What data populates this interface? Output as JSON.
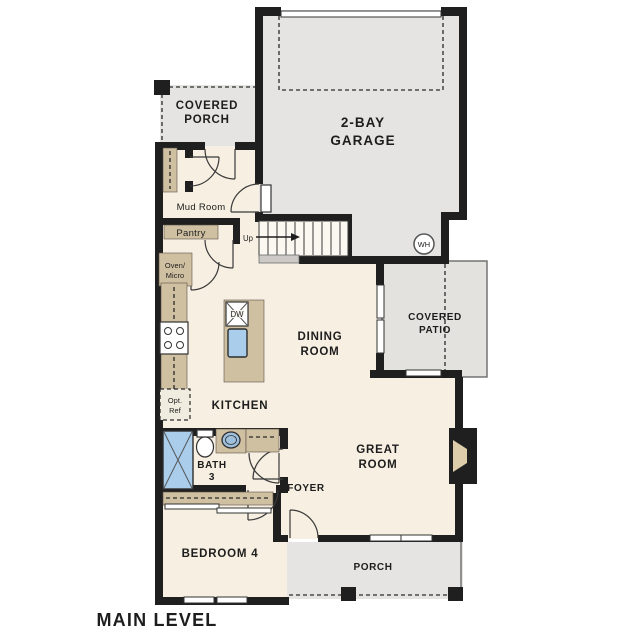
{
  "page": {
    "title": "MAIN LEVEL"
  },
  "colors": {
    "wall": "#1f1f1f",
    "floor": "#f7f0e2",
    "concrete": "#e5e4e2",
    "cabinetry": "#cfc0a2",
    "water_fixture": "#aacdec"
  },
  "rooms": {
    "covered_porch": {
      "line1": "COVERED",
      "line2": "PORCH"
    },
    "garage": {
      "line1": "2-BAY",
      "line2": "GARAGE"
    },
    "mud_room": {
      "label": "Mud Room"
    },
    "pantry": {
      "label": "Pantry"
    },
    "dining": {
      "line1": "DINING",
      "line2": "ROOM"
    },
    "covered_patio": {
      "line1": "COVERED",
      "line2": "PATIO"
    },
    "kitchen": {
      "label": "KITCHEN"
    },
    "great_room": {
      "line1": "GREAT",
      "line2": "ROOM"
    },
    "bath": {
      "line1": "BATH",
      "line2": "3"
    },
    "foyer": {
      "label": "FOYER"
    },
    "bedroom": {
      "label": "BEDROOM 4"
    },
    "porch": {
      "label": "PORCH"
    }
  },
  "annotations": {
    "up": "Up",
    "dw": "DW",
    "wh": "WH",
    "oven_micro": {
      "line1": "Oven/",
      "line2": "Micro"
    },
    "opt_ref": {
      "line1": "Opt.",
      "line2": "Ref"
    }
  },
  "footer": {
    "label": "MAIN LEVEL"
  }
}
